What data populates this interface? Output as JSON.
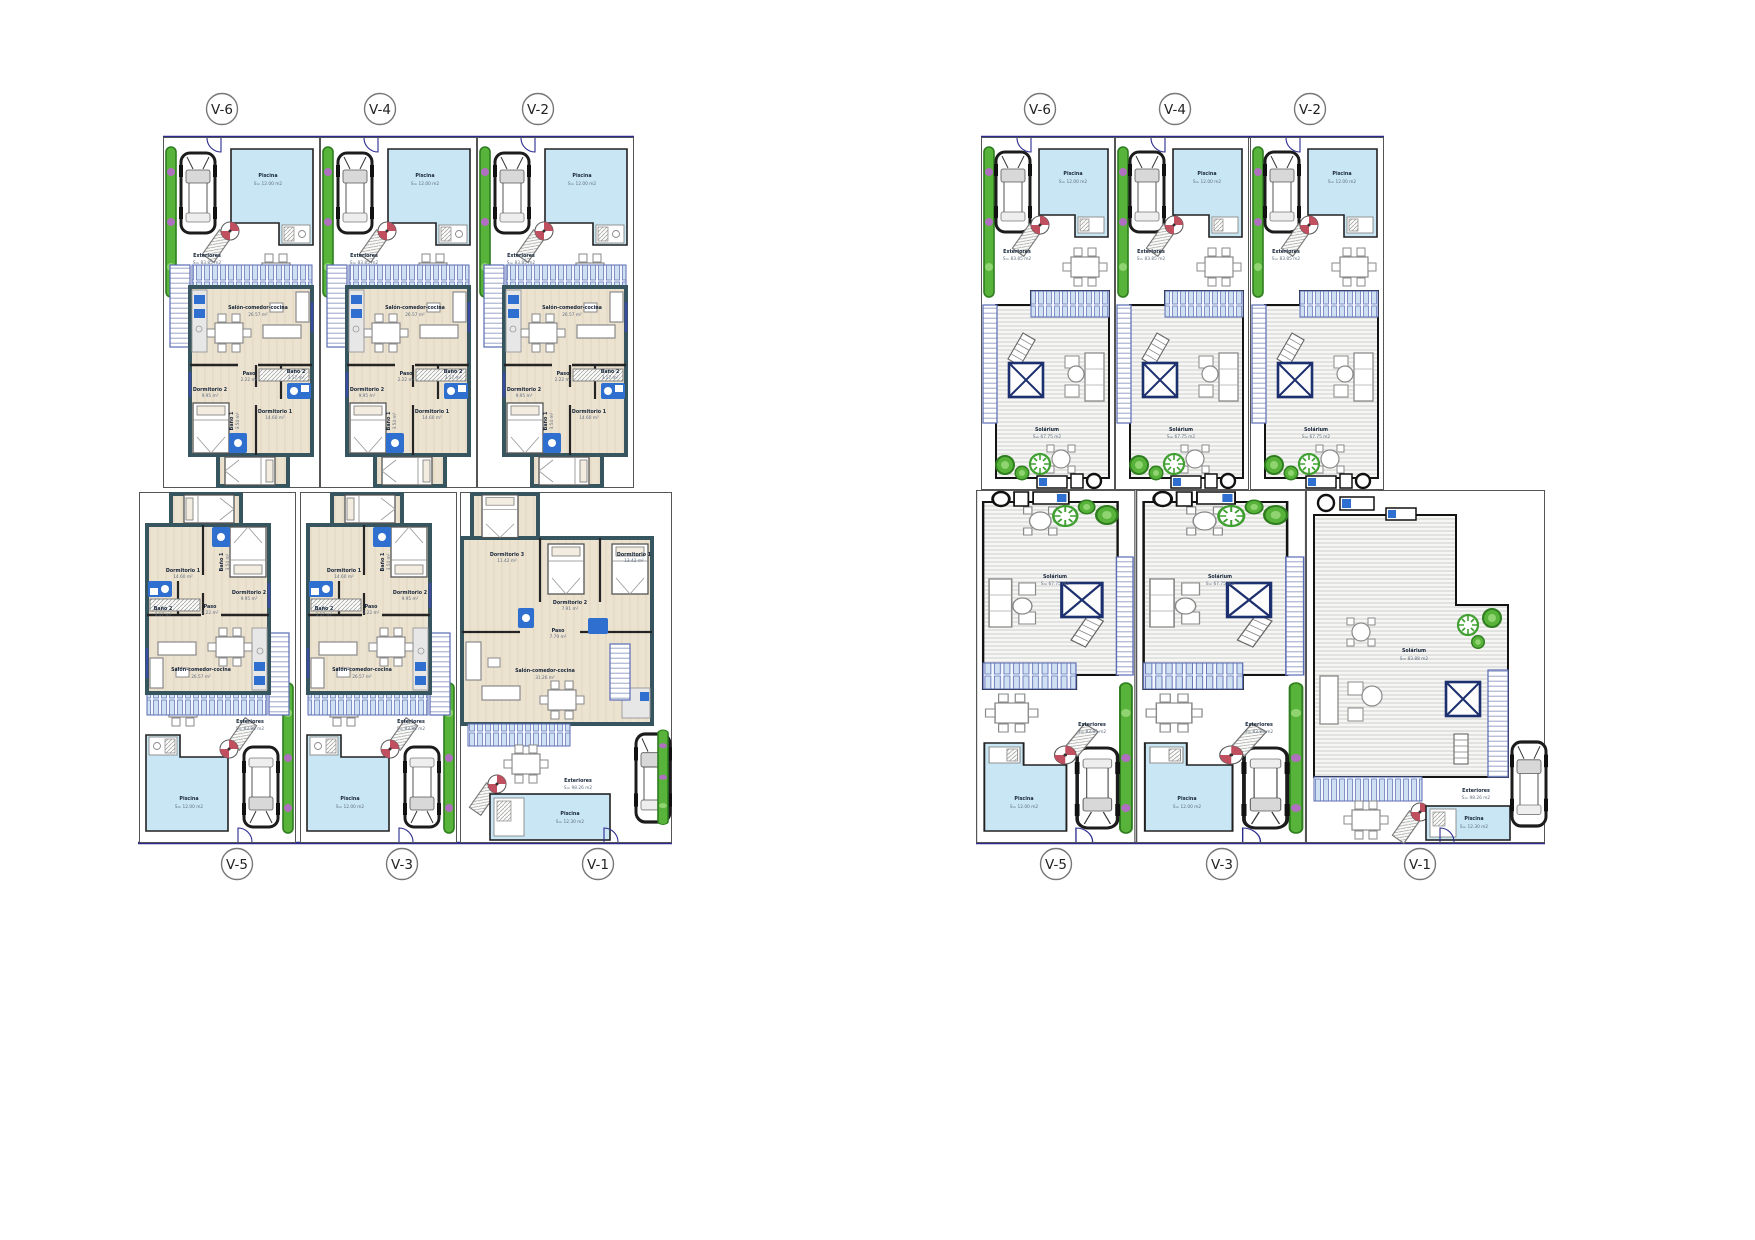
{
  "units": {
    "top": [
      "V-6",
      "V-4",
      "V-2"
    ],
    "bottom": [
      "V-5",
      "V-3",
      "V-1"
    ]
  },
  "common": {
    "piscina_l": "Piscina",
    "piscina_a": "S= 12.00 m2",
    "exteriores_l": "Exteriores",
    "exteriores_a": "S= 83.85 m2",
    "piscina_v1_a": "S= 12.30 m2",
    "exteriores_v1_a": "S= 98.26 m2"
  },
  "ground": {
    "salon_l": "Salón-comedor-cocina",
    "salon_a": "26.57 m²",
    "paso_l": "Paso",
    "paso_a": "2.22 m²",
    "bano2_l": "Baño 2",
    "bano2_a": "3.17 m²",
    "dorm2_l": "Dormitorio 2",
    "dorm2_a": "9.95 m²",
    "bano1_l": "Baño 1",
    "bano1_a": "3.54 m²",
    "dorm1_l": "Dormitorio 1",
    "dorm1_a": "14.60 m²",
    "v1": {
      "salon_a": "31.26 m²",
      "paso_a": "7.79 m²",
      "dorm1_a": "13.42 m²",
      "dorm2_a": "7.91 m²",
      "dorm3_l": "Dormitorio 3",
      "dorm3_a": "11.42 m²"
    }
  },
  "solar": {
    "solarium_l": "Solárium",
    "solarium_a": "S= 67.75 m2",
    "v1": {
      "solarium_a": "S= 83.88 m2"
    }
  },
  "colors": {
    "pool": "#c9e6f4",
    "walls": "#3a5a63",
    "floor": "#ece2d0",
    "fixture_blue": "#2f6fd0",
    "boundary_navy": "#2b2b8f",
    "deck_stripe": "#d2d2cf",
    "plant_green": "#57b33a",
    "pergola_bar": "#cfe0f2"
  }
}
